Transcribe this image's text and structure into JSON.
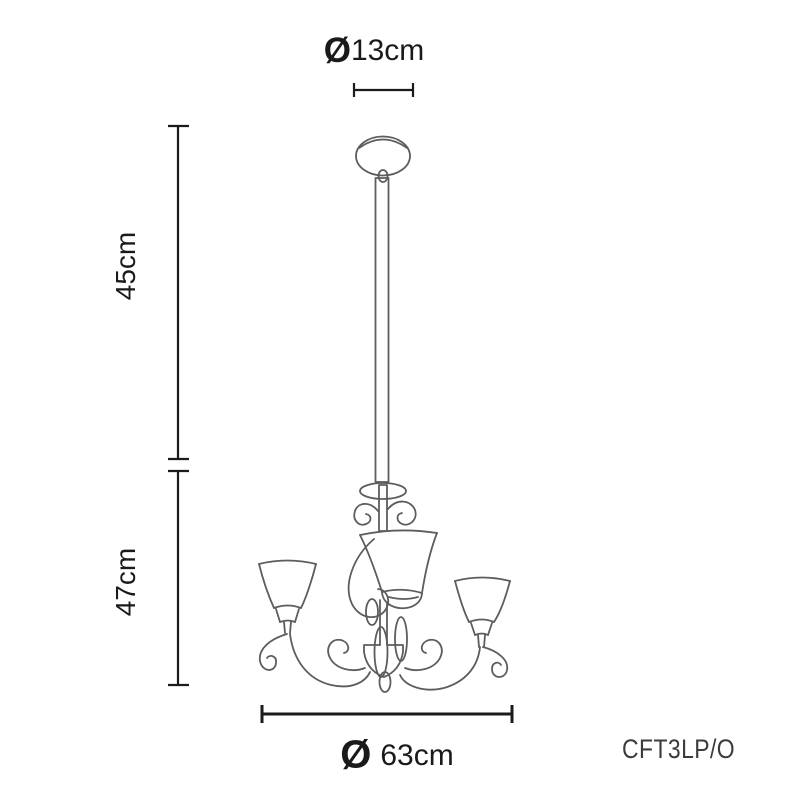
{
  "diagram": {
    "type": "dimensioned-line-drawing",
    "subject": "three-arm chandelier with chain suspension"
  },
  "labels": {
    "canopy_diameter": {
      "symbol": "Ø",
      "value": "13cm"
    },
    "chain_length": "45cm",
    "body_height": "47cm",
    "fixture_diameter": {
      "symbol": "Ø",
      "value": "63cm"
    },
    "product_code": "CFT3LP/O"
  },
  "colors": {
    "background": "#ffffff",
    "drawing_line": "#5d5d5f",
    "dimension_line": "#1b1b1b",
    "text": "#1a1a1a",
    "product_code_text": "#3c3c3c"
  }
}
